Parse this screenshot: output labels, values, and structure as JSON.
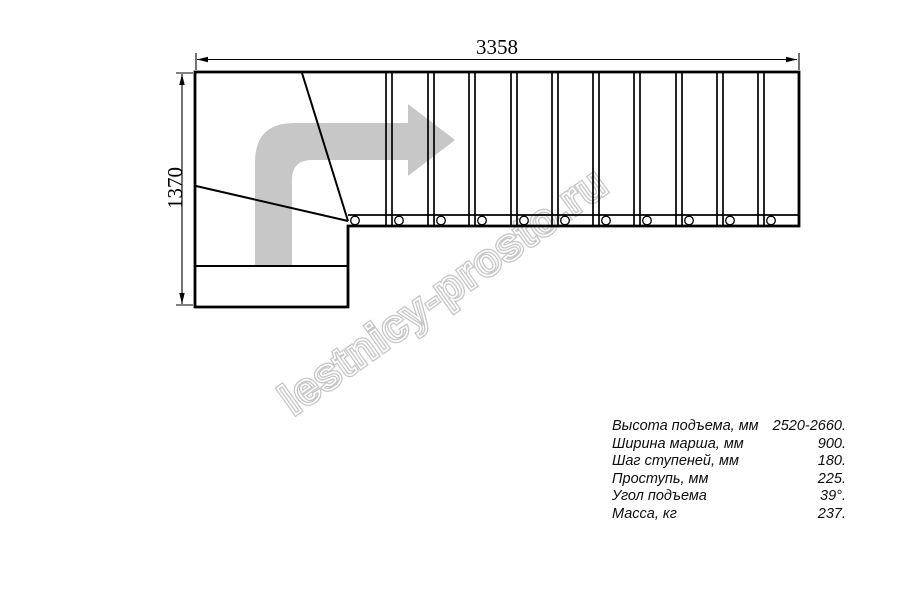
{
  "diagram": {
    "title_hint": "stair plan top view",
    "dimensions": {
      "width_label": "3358",
      "height_label": "1370"
    },
    "watermark": "lestnicy-prosto.ru",
    "stair": {
      "straight_tread_count": 11,
      "baluster_circle_count": 11
    },
    "colors": {
      "line": "#000000",
      "arrow_fill": "#c7c7c7",
      "watermark_stroke": "#c6c6c6"
    }
  },
  "specs": {
    "rows": [
      {
        "label": "Высота подъема, мм",
        "value": "2520-2660."
      },
      {
        "label": "Ширина марша, мм",
        "value": "900."
      },
      {
        "label": "Шаг ступеней, мм",
        "value": "180."
      },
      {
        "label": "Проступь, мм",
        "value": "225."
      },
      {
        "label": "Угол подъема",
        "value": "39°."
      },
      {
        "label": "Масса, кг",
        "value": "237."
      }
    ]
  }
}
